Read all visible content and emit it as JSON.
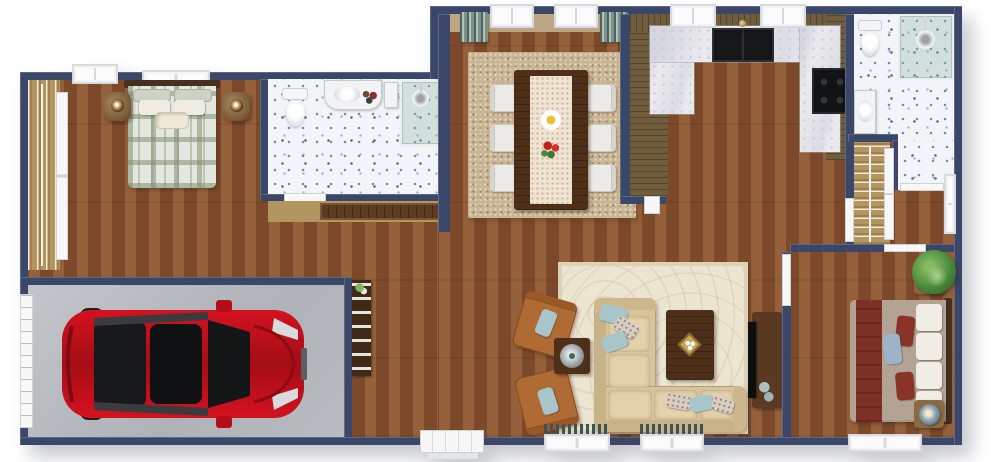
{
  "meta": {
    "kind": "3d-floor-plan-top-view",
    "style": "photoreal render, no text labels"
  },
  "palette": {
    "wall": "#3b4769",
    "wood": "#8a5330",
    "tile": "#f2f4f8",
    "speckle": "#6e87b5",
    "garageFloor": "#b7babf",
    "marble": "#eaeaee",
    "panel": "#6f5d3b",
    "rugDining": "#c9b593",
    "rugLiving": "#ece5d2",
    "sofa": "#d8c49c",
    "rust": "#b06a33",
    "pillowBlue": "#a7c6cb",
    "darkWood": "#4e3018",
    "plaid": "#e4e7e0",
    "maroon": "#7d3026",
    "taupe": "#b3a394",
    "teal": "#7c938c",
    "curtainDark": "#3f5256",
    "carRed": "#c3101f",
    "plant": "#4a8a3c",
    "closetTan": "#b3955f",
    "door": "#f7f7f7"
  },
  "rooms": [
    {
      "id": "bedroom-master",
      "label": "Master bedroom with plaid double bed, two nightstands with lamps, hanging closet"
    },
    {
      "id": "bathroom-main",
      "label": "Main bathroom with toilet, vanity and glass shower"
    },
    {
      "id": "dining-room",
      "label": "Dining room with table for six on shag rug"
    },
    {
      "id": "kitchen",
      "label": "U-shaped kitchen with marble counters, black sink and range"
    },
    {
      "id": "bathroom-ensuite",
      "label": "Second bathroom with toilet and corner glass shower"
    },
    {
      "id": "walk-in-closet",
      "label": "Walk-in closet with hanging rail"
    },
    {
      "id": "living-room",
      "label": "Living room with L-sectional, armchairs, coffee table and TV console"
    },
    {
      "id": "bedroom-second",
      "label": "Second bedroom with maroon bed, blue lamps and plant"
    },
    {
      "id": "garage",
      "label": "Single garage with red car"
    },
    {
      "id": "hallway",
      "label": "Central hallway"
    },
    {
      "id": "entry",
      "label": "Front entry door"
    }
  ],
  "furniture": {
    "car": "Red hatchback car, top view",
    "bed_master": "Double bed with green plaid duvet",
    "bed_second": "Double bed with maroon and taupe bedding",
    "sofa": "Beige L-shaped sectional sofa",
    "coffee_table": "Dark wood coffee table with tray",
    "tv_console": "TV console with flat screen",
    "armchair": "Rust armchair with blue pillow",
    "side_table": "Side table with lamp",
    "dining_table": "Dark wood dining table with runner, plate and flowers",
    "dining_chair": "White dining chair",
    "toilet": "Toilet",
    "shower": "Glass shower with rain head",
    "vanity_sink": "Vanity with sink",
    "kitchen_sink": "Black double-basin sink",
    "range": "Black range",
    "plant": "Potted green plant",
    "closet_rail": "Closet rail with hangers",
    "bookshelf": "Hall shelf with books",
    "garage_door": "Garage door",
    "front_door": "Front entry door",
    "window": "Window",
    "curtains": "Teal curtains"
  }
}
